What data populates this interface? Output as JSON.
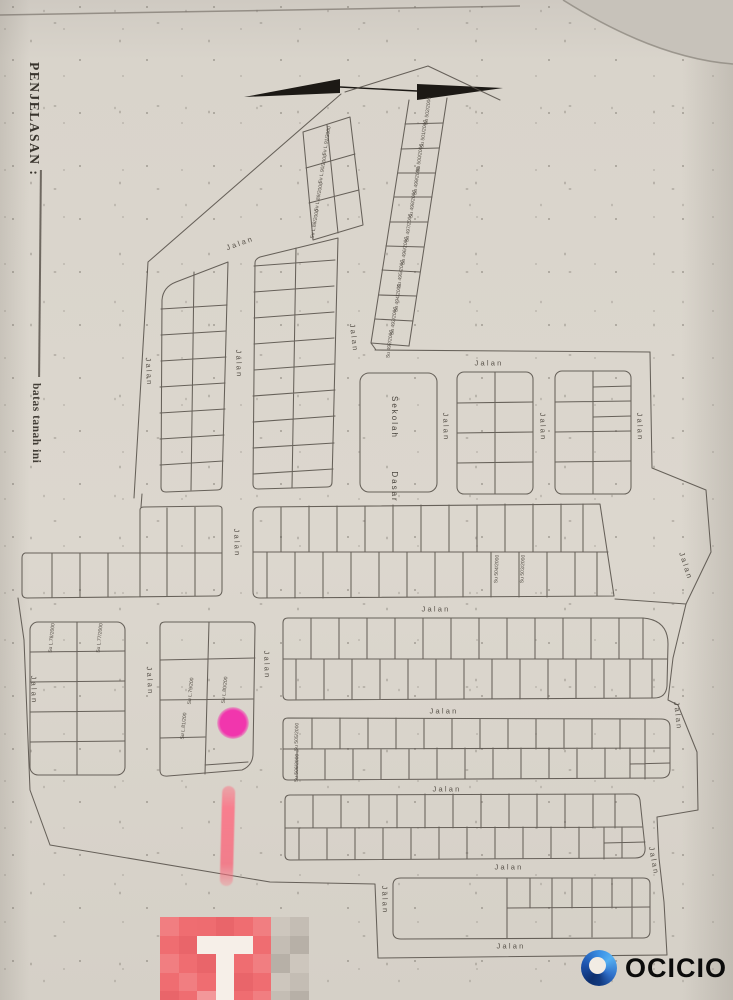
{
  "colors": {
    "paper": "#d8d3ca",
    "ink": "#57514a",
    "arrow_black": "#1c1915",
    "pink_dot": "#f136ad",
    "pink_stroke": "#f87e8e"
  },
  "margin": {
    "title": "PENJELASAN :",
    "note": "batas tanah ini"
  },
  "school_label": "Sekolah  Dasar",
  "streets": [
    {
      "t": "Jalan",
      "x": 240,
      "y": 243,
      "r": -20
    },
    {
      "t": "Jalan",
      "x": 354,
      "y": 338,
      "r": 83
    },
    {
      "t": "Jalan",
      "x": 149,
      "y": 372,
      "r": 87
    },
    {
      "t": "Jalan",
      "x": 239,
      "y": 364,
      "r": 88
    },
    {
      "t": "Jalan",
      "x": 489,
      "y": 363,
      "r": 0
    },
    {
      "t": "Jalan",
      "x": 446,
      "y": 427,
      "r": 88
    },
    {
      "t": "Jalan",
      "x": 543,
      "y": 427,
      "r": 88
    },
    {
      "t": "Jalan",
      "x": 640,
      "y": 427,
      "r": 88
    },
    {
      "t": "Jalan",
      "x": 237,
      "y": 543,
      "r": 88
    },
    {
      "t": "Jalan",
      "x": 436,
      "y": 609,
      "r": 0
    },
    {
      "t": "Jalan",
      "x": 686,
      "y": 566,
      "r": 72
    },
    {
      "t": "Jalan",
      "x": 34,
      "y": 690,
      "r": 88
    },
    {
      "t": "Jalan",
      "x": 150,
      "y": 681,
      "r": 87
    },
    {
      "t": "Jalan",
      "x": 267,
      "y": 665,
      "r": 88
    },
    {
      "t": "Jalan",
      "x": 444,
      "y": 711,
      "r": 0
    },
    {
      "t": "Jalan",
      "x": 678,
      "y": 716,
      "r": 84
    },
    {
      "t": "Jalan",
      "x": 447,
      "y": 789,
      "r": 0
    },
    {
      "t": "Jalan",
      "x": 509,
      "y": 867,
      "r": 0
    },
    {
      "t": "Jalan",
      "x": 385,
      "y": 900,
      "r": 88
    },
    {
      "t": "Jalan",
      "x": 654,
      "y": 861,
      "r": 80
    },
    {
      "t": "Jalan",
      "x": 511,
      "y": 946,
      "r": 0
    }
  ],
  "plots": [
    {
      "t": "Su 502/2000",
      "x": 428,
      "y": 111,
      "r": -83
    },
    {
      "t": "Su 501/2000",
      "x": 424,
      "y": 134,
      "r": -83
    },
    {
      "t": "Su 500/2000",
      "x": 420,
      "y": 158,
      "r": -83
    },
    {
      "t": "Su 499/2000",
      "x": 417,
      "y": 181,
      "r": -83
    },
    {
      "t": "Su 498/2000",
      "x": 413,
      "y": 204,
      "r": -83
    },
    {
      "t": "Su 497/2000",
      "x": 409,
      "y": 228,
      "r": -83
    },
    {
      "t": "Su 496/2000",
      "x": 405,
      "y": 251,
      "r": -83
    },
    {
      "t": "Su 495/2000",
      "x": 401,
      "y": 274,
      "r": -83
    },
    {
      "t": "Su 494/2000",
      "x": 398,
      "y": 298,
      "r": -83
    },
    {
      "t": "Su 493/2000",
      "x": 394,
      "y": 321,
      "r": -83
    },
    {
      "t": "Su 492/2000",
      "x": 390,
      "y": 344,
      "r": -83
    },
    {
      "t": "Su L.91/2000",
      "x": 327,
      "y": 141,
      "r": -80
    },
    {
      "t": "Su L.90/2000",
      "x": 323,
      "y": 169,
      "r": -80
    },
    {
      "t": "Su L.89/2000",
      "x": 319,
      "y": 197,
      "r": -80
    },
    {
      "t": "Su L.88/2000",
      "x": 315,
      "y": 224,
      "r": -80
    },
    {
      "t": "Su 504/2000",
      "x": 497,
      "y": 569,
      "r": -87
    },
    {
      "t": "Su 503/2000",
      "x": 523,
      "y": 569,
      "r": -87
    },
    {
      "t": "Su 505/2000",
      "x": 297,
      "y": 737,
      "r": -88
    },
    {
      "t": "Su 506/2000",
      "x": 297,
      "y": 768,
      "r": -88
    },
    {
      "t": "Su L.78/2000",
      "x": 52,
      "y": 638,
      "r": -84
    },
    {
      "t": "Su L.77/2000",
      "x": 100,
      "y": 638,
      "r": -84
    },
    {
      "t": "Su L.79/200",
      "x": 191,
      "y": 691,
      "r": -84
    },
    {
      "t": "Su L.80/200",
      "x": 225,
      "y": 690,
      "r": -84
    },
    {
      "t": "Su L.81/200",
      "x": 184,
      "y": 726,
      "r": -84
    }
  ],
  "mosaic": {
    "x": 160,
    "y": 917,
    "cell": 18.5,
    "rows": [
      [
        "#f17e81",
        "#ef6d71",
        "#ee6c70",
        "#e9656a",
        "#ef6d71",
        "#f17e81",
        "#cdc6bd",
        "#c4bdb4"
      ],
      [
        "#ef6d71",
        "#e9656a",
        "#f6efe8",
        "#f6efe8",
        "#f6efe8",
        "#ef6d71",
        "#c4bdb4",
        "#b7b0a7"
      ],
      [
        "#f17e81",
        "#ef6d71",
        "#e9656a",
        "#f6efe8",
        "#ef6d71",
        "#f17e81",
        "#b7b0a7",
        "#cdc6bd"
      ],
      [
        "#ef6d71",
        "#f17e81",
        "#ef6d71",
        "#f6efe8",
        "#e9656a",
        "#ef6d71",
        "#cdc6bd",
        "#c4bdb4"
      ],
      [
        "#e9656a",
        "#ef6d71",
        "#f3989a",
        "#f6efe8",
        "#ef6d71",
        "#f17e81",
        "#c4bdb4",
        "#b7b0a7"
      ]
    ]
  },
  "logo": {
    "text": "OCICIO"
  }
}
